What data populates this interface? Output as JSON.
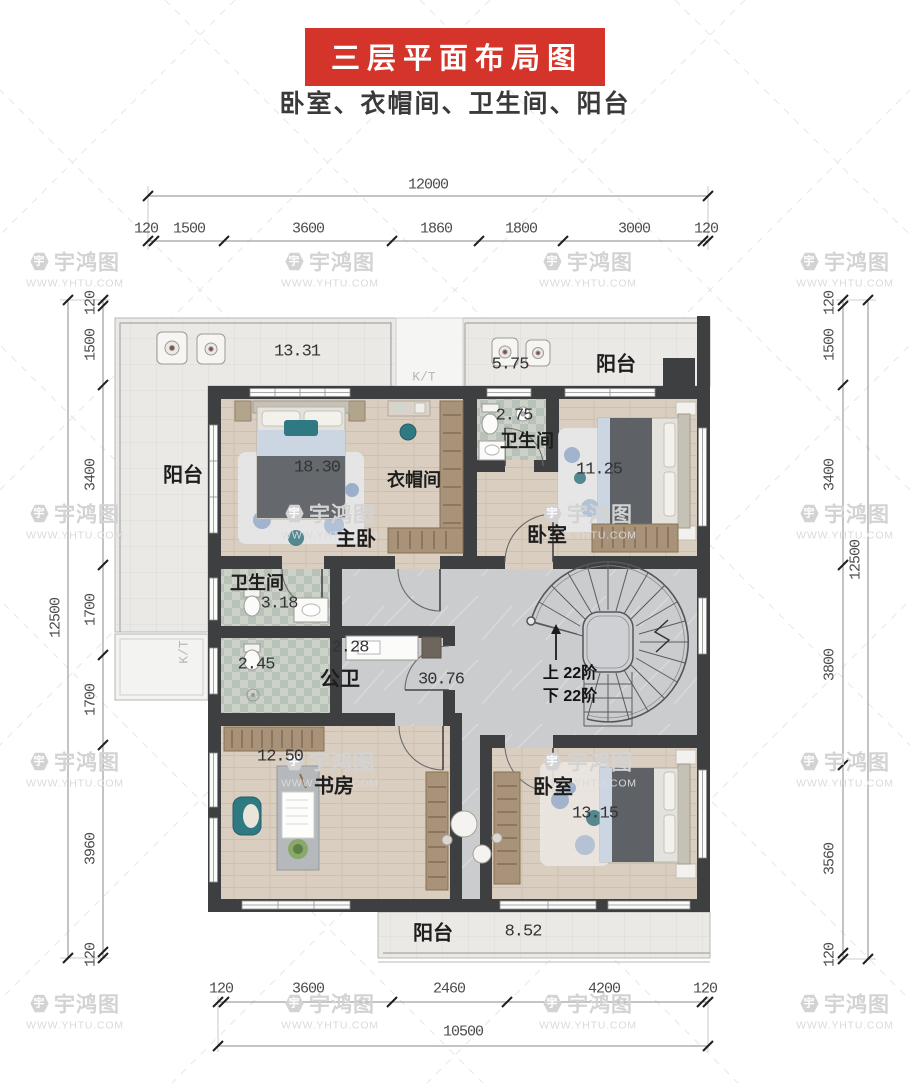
{
  "header": {
    "title": "三层平面布局图",
    "subtitle": "卧室、衣帽间、卫生间、阳台"
  },
  "watermark": {
    "brand": "宇鸿图",
    "url": "WWW.YHTU.COM",
    "logo_glyph": "宇"
  },
  "colors": {
    "banner_red": "#d5342b",
    "wall": "#3e3f41",
    "wood_floor": "#dacec1",
    "marble_floor": "#cbccce",
    "balcony_tile": "#eae9e6",
    "bath_tile": "#c6cdc4",
    "closet_wood": "#a8927a",
    "accent_teal": "#2f7a82",
    "blanket_gray": "#5e6266"
  },
  "dimensions": {
    "top_overall": "12000",
    "top_segments": [
      "120",
      "1500",
      "3600",
      "1860",
      "1800",
      "3000",
      "120"
    ],
    "left_overall": "12500",
    "left_segments": [
      "120",
      "1500",
      "3400",
      "1700",
      "1700",
      "3960",
      "120"
    ],
    "right_overall": "12500",
    "right_segments": [
      "120",
      "1500",
      "3400",
      "3800",
      "3560",
      "120"
    ],
    "bottom_overall": "10500",
    "bottom_segments": [
      "120",
      "3600",
      "2460",
      "4200",
      "120"
    ]
  },
  "rooms": {
    "balcony_left": {
      "name": "阳台",
      "area": "13.31"
    },
    "balcony_top": {
      "name": "阳台",
      "area": "5.75"
    },
    "master": {
      "name": "主卧",
      "area": "18.30"
    },
    "cloak": {
      "name": "衣帽间"
    },
    "bath_top": {
      "name": "卫生间",
      "area": "2.75"
    },
    "bed_right": {
      "name": "卧室",
      "area": "11.25"
    },
    "bath_mid": {
      "name": "卫生间",
      "area": "3.18"
    },
    "shower_room": {
      "area": "2.45"
    },
    "pub_bath": {
      "name": "公卫",
      "area": "2.28"
    },
    "hall": {
      "area": "30.76"
    },
    "study": {
      "name": "书房",
      "area": "12.50"
    },
    "bed_bottom": {
      "name": "卧室",
      "area": "13.15"
    },
    "balcony_bottom": {
      "name": "阳台",
      "area": "8.52"
    }
  },
  "stairs": {
    "up": "上 22阶",
    "down": "下 22阶"
  },
  "labels": {
    "kt": "K/T"
  }
}
